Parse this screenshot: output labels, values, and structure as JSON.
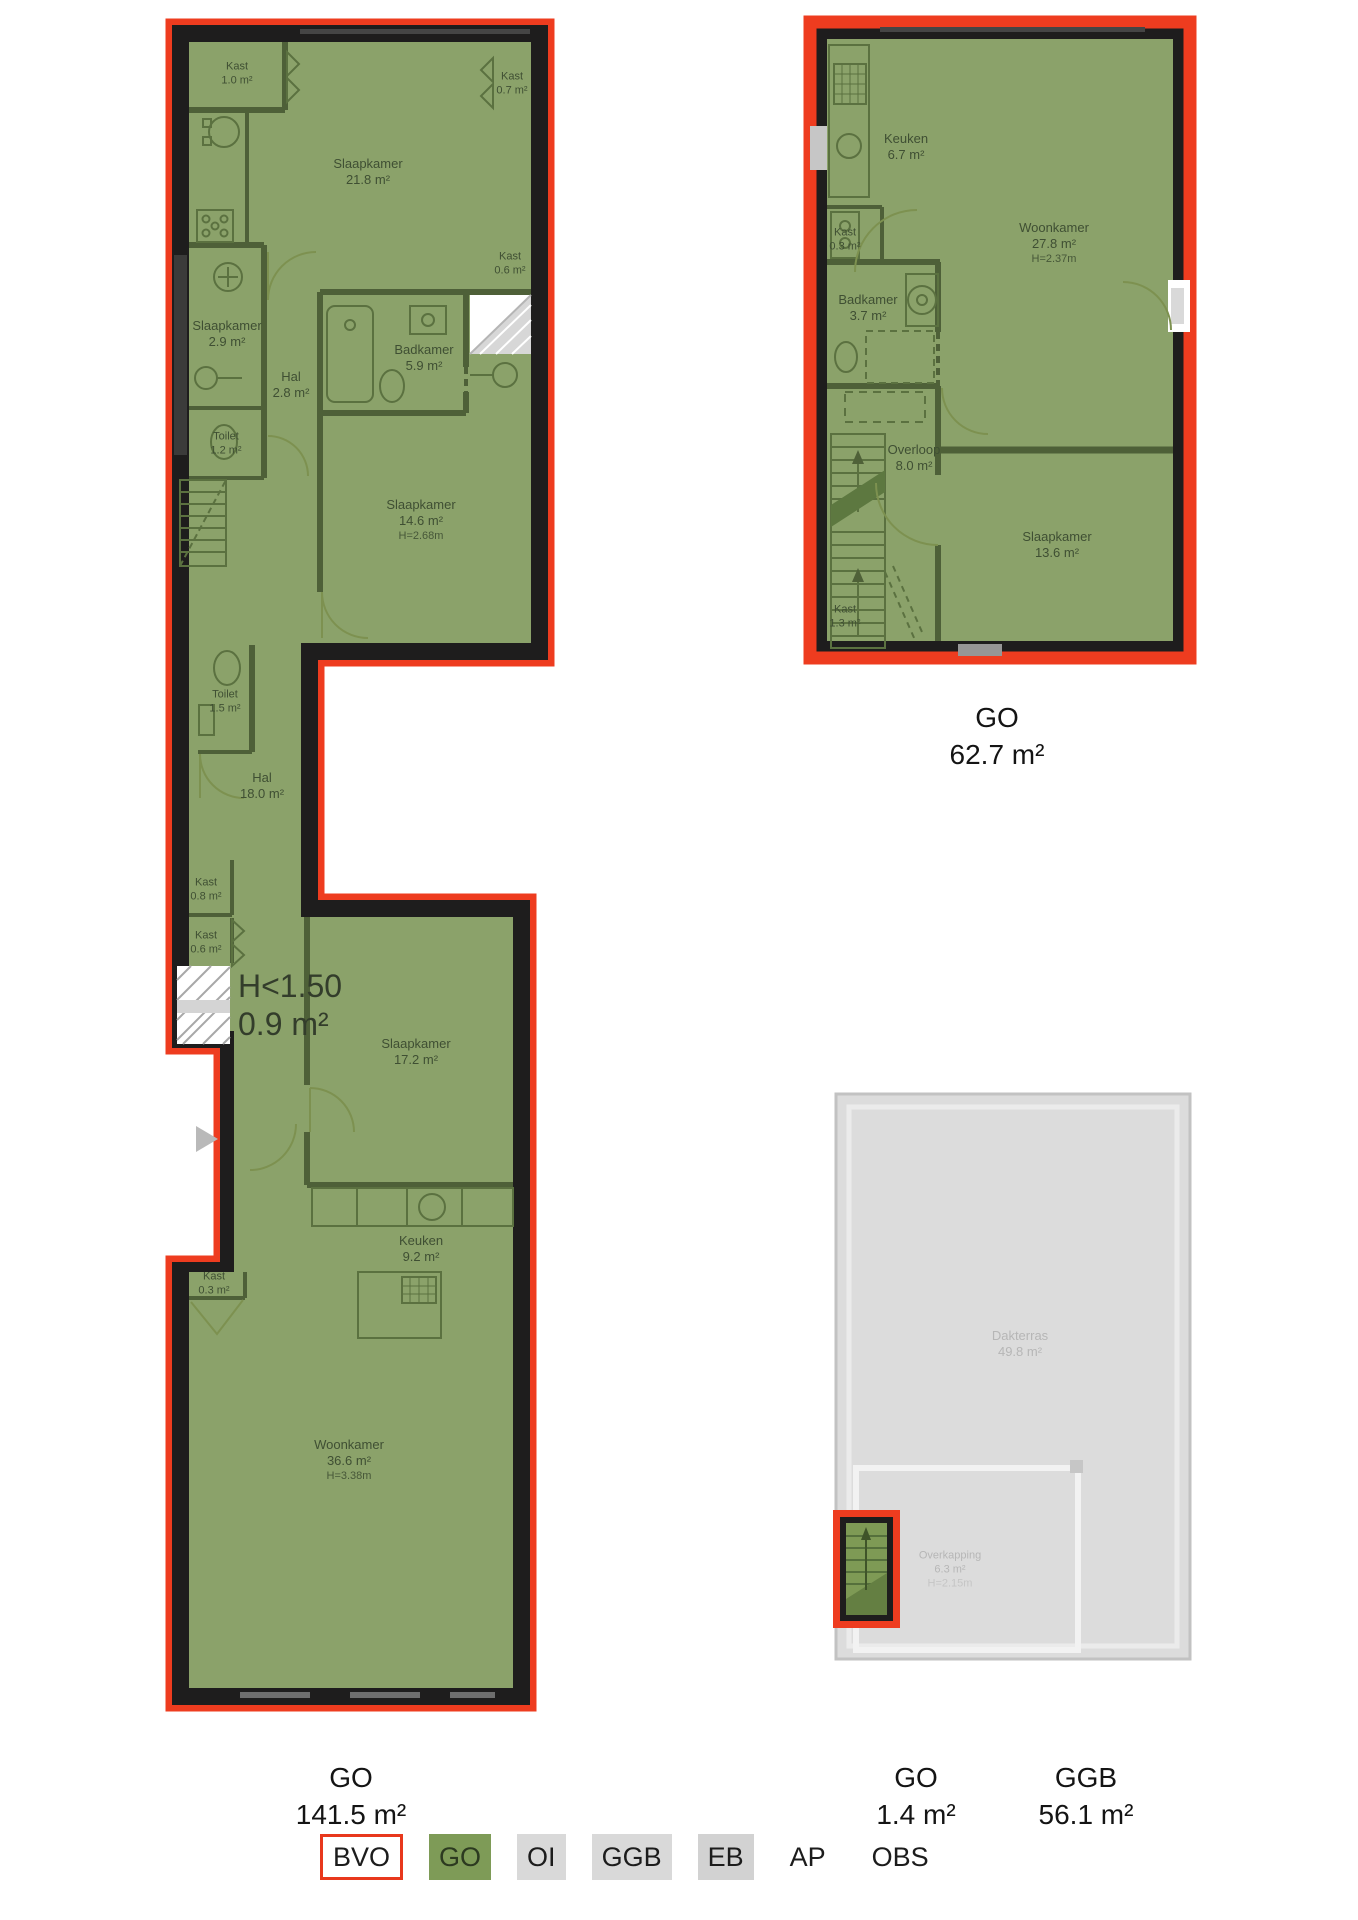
{
  "plans": {
    "floor1": {
      "caption": {
        "type": "GO",
        "area": "141.5 m²"
      },
      "annotation": {
        "line1": "H<1.50",
        "line2": "0.9 m²"
      },
      "rooms": [
        {
          "name": "Kast",
          "area": "1.0 m²"
        },
        {
          "name": "Slaapkamer",
          "area": "21.8 m²"
        },
        {
          "name": "Kast",
          "area": "0.7 m²"
        },
        {
          "name": "Kast",
          "area": "0.6 m²"
        },
        {
          "name": "Slaapkamer",
          "area": "2.9 m²"
        },
        {
          "name": "Hal",
          "area": "2.8 m²"
        },
        {
          "name": "Badkamer",
          "area": "5.9 m²"
        },
        {
          "name": "Toilet",
          "area": "1.2 m²"
        },
        {
          "name": "Slaapkamer",
          "area": "14.6 m²",
          "height": "H=2.68m"
        },
        {
          "name": "Toilet",
          "area": "1.5 m²"
        },
        {
          "name": "Hal",
          "area": "18.0 m²"
        },
        {
          "name": "Kast",
          "area": "0.8 m²"
        },
        {
          "name": "Kast",
          "area": "0.6 m²"
        },
        {
          "name": "Slaapkamer",
          "area": "17.2 m²"
        },
        {
          "name": "Keuken",
          "area": "9.2 m²"
        },
        {
          "name": "Kast",
          "area": "0.3 m²"
        },
        {
          "name": "Woonkamer",
          "area": "36.6 m²",
          "height": "H=3.38m"
        }
      ]
    },
    "floor2": {
      "caption": {
        "type": "GO",
        "area": "62.7 m²"
      },
      "rooms": [
        {
          "name": "Keuken",
          "area": "6.7 m²"
        },
        {
          "name": "Woonkamer",
          "area": "27.8 m²",
          "height": "H=2.37m"
        },
        {
          "name": "Kast",
          "area": "0.3 m²"
        },
        {
          "name": "Badkamer",
          "area": "3.7 m²"
        },
        {
          "name": "Overloop",
          "area": "8.0 m²"
        },
        {
          "name": "Slaapkamer",
          "area": "13.6 m²"
        },
        {
          "name": "Kast",
          "area": "1.3 m²"
        }
      ]
    },
    "roof": {
      "captions": [
        {
          "type": "GO",
          "area": "1.4 m²"
        },
        {
          "type": "GGB",
          "area": "56.1 m²"
        }
      ],
      "rooms": [
        {
          "name": "Dakterras",
          "area": "49.8 m²"
        },
        {
          "name": "Overkapping",
          "area": "6.3 m²",
          "height": "H=2.15m"
        }
      ]
    }
  },
  "legend": {
    "items": [
      {
        "label": "BVO",
        "fill": "#ffffff",
        "border": "#e8381c"
      },
      {
        "label": "GO",
        "fill": "#7e9b57"
      },
      {
        "label": "OI",
        "fill": "#d9d9d9"
      },
      {
        "label": "GGB",
        "fill": "#d9d9d9"
      },
      {
        "label": "EB",
        "fill": "#d2d2d2"
      },
      {
        "label": "AP",
        "fill": "none"
      },
      {
        "label": "OBS",
        "fill": "none"
      }
    ]
  },
  "colors": {
    "bvo_red": "#ee3c1f",
    "wall_black": "#1e1d1d",
    "go_green": "#8ba26a",
    "interior_wall": "#4e6038",
    "terrace_gray": "#dcdcdc",
    "label_olive": "#3f4f33"
  }
}
